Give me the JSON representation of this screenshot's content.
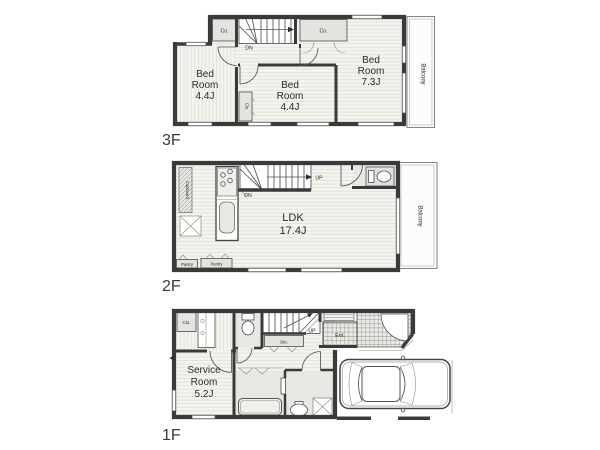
{
  "colors": {
    "bg": "#ffffff",
    "wall": "#3a3a3a",
    "line": "#555555",
    "floor_bg": "#f2f4ee",
    "floor_line": "#dde1d8",
    "fixture": "#e2e5df",
    "tile_bg": "#e9ebe5",
    "tile_line": "#9aa096",
    "text": "#2b2b2b"
  },
  "floor3": {
    "label": "3F",
    "bedroom_left": {
      "lines": [
        "Bed",
        "Room",
        "4.4J"
      ]
    },
    "bedroom_mid": {
      "lines": [
        "Bed",
        "Room",
        "4.4J"
      ]
    },
    "bedroom_right": {
      "lines": [
        "Bed",
        "Room",
        "7.3J"
      ]
    },
    "balcony": "Balcony",
    "closet_top_left": "Co.",
    "closet_top_right": "Co.",
    "closet_mid": "Clo.",
    "stairs_down": "DN"
  },
  "floor2": {
    "label": "2F",
    "ldk": {
      "lines": [
        "LDK",
        "17.4J"
      ]
    },
    "balcony": "Balcony",
    "cupboard": "Cupboard",
    "pantry_left": "Pantry",
    "pantry_right": "Pantry",
    "stairs_up": "UP",
    "stairs_down": "DN"
  },
  "floor1": {
    "label": "1F",
    "service_room": {
      "lines": [
        "Service",
        "Room",
        "5.2J"
      ]
    },
    "closet": "Clo.",
    "storage": "Sto.",
    "entrance": "Ent.",
    "stairs_up": "UP"
  }
}
